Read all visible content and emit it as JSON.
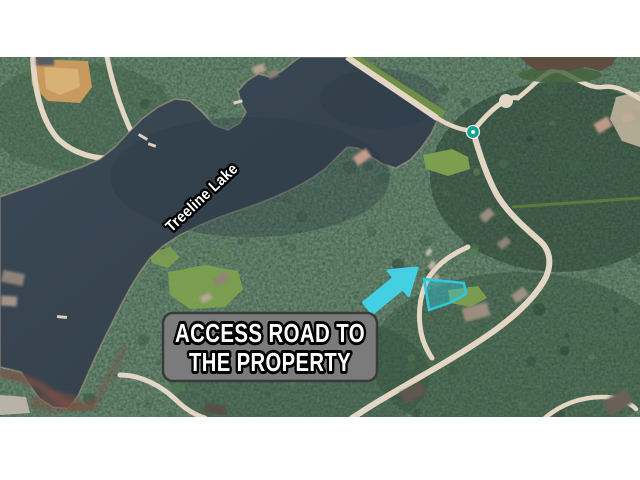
{
  "annotation": {
    "lake_label": "Treeline Lake",
    "caption_line1": "ACCESS ROAD TO",
    "caption_line2": "THE PROPERTY"
  },
  "map": {
    "type": "satellite-aerial-photo",
    "visible_features": [
      "lake",
      "forest",
      "roads",
      "houses",
      "dam",
      "pond",
      "poi-marker",
      "highlighted-parcel",
      "access-road-arrow"
    ]
  },
  "colors": {
    "highlight": "#44D0E3",
    "parcel-stroke": "#2FC8DE",
    "parcel-fill": "rgba(47,200,222,0.42)",
    "caption-bg": "rgba(124,124,124,0.95)",
    "caption-border": "#3A3A3A",
    "caption-text": "#FFFFFF",
    "water": "#36434F",
    "water-deep": "#2C3844",
    "forest": "#2E4536",
    "road": "#E4D6C4",
    "clearing": "#C89A5F",
    "lawn": "#7FA24F",
    "sediment": "#7B5044",
    "marker": "#14A28E",
    "letterbox": "#FFFFFF"
  }
}
